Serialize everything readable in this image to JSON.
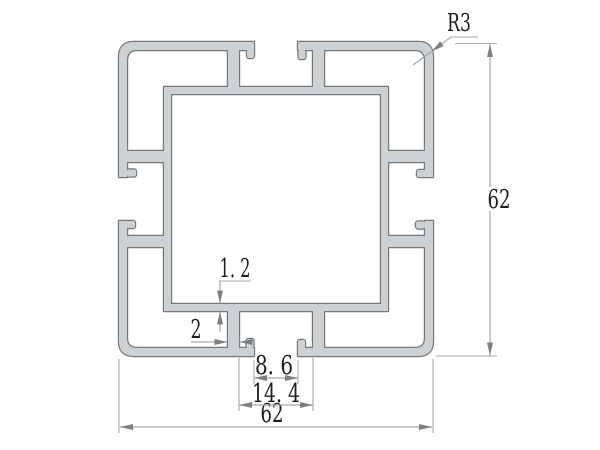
{
  "drawing": {
    "title": "aluminium extrusion profile cross-section technical drawing",
    "background_color": "#ffffff",
    "profile": {
      "wall_fill_color": "#cdd1d4",
      "wall_outline_color": "#73787b",
      "corner_radius_label": "R3"
    },
    "dimension_style": {
      "line_color": "#a3a8ac",
      "arrow_color": "#7b8186",
      "text_color": "#1b1d20"
    },
    "dimensions": {
      "corner_radius": {
        "label": "R3"
      },
      "overall_height": {
        "label": "62"
      },
      "overall_width": {
        "label": "62"
      },
      "inner_wall_thickness": {
        "label": "1. 2"
      },
      "web_thickness": {
        "label": "2"
      },
      "slot_opening_width": {
        "label": "8. 6"
      },
      "slot_inner_width": {
        "label": "14. 4"
      }
    }
  }
}
